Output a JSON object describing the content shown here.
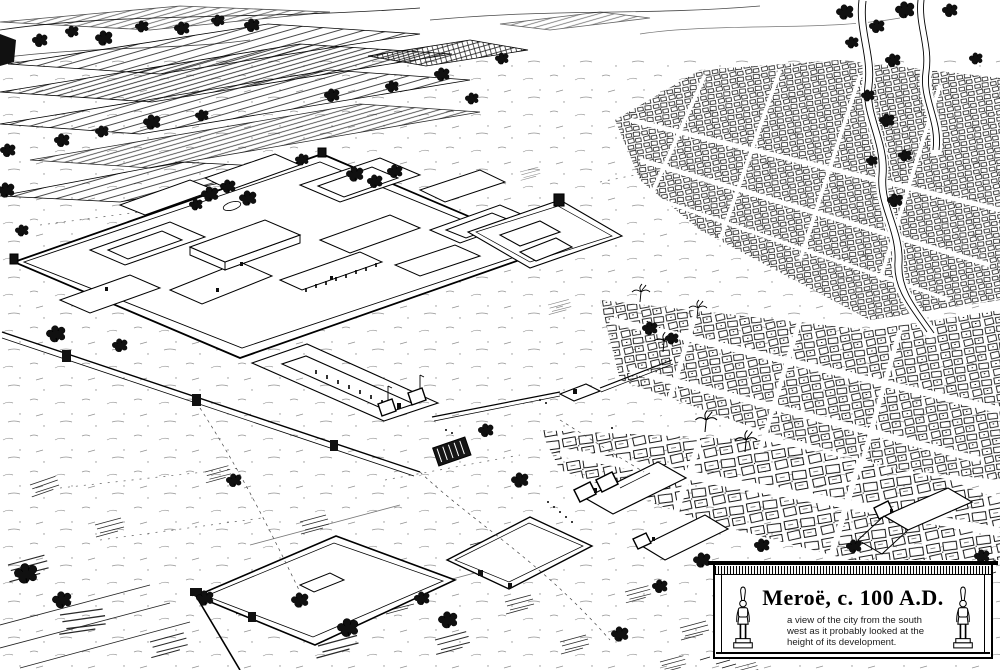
{
  "colors": {
    "ink": "#000000",
    "paper": "#ffffff"
  },
  "figure": {
    "caption": {
      "title": "Meroë, c. 100 A.D.",
      "lines": [
        "a view of the city from the south",
        "west as it probably looked at the",
        "height of its development."
      ]
    }
  }
}
